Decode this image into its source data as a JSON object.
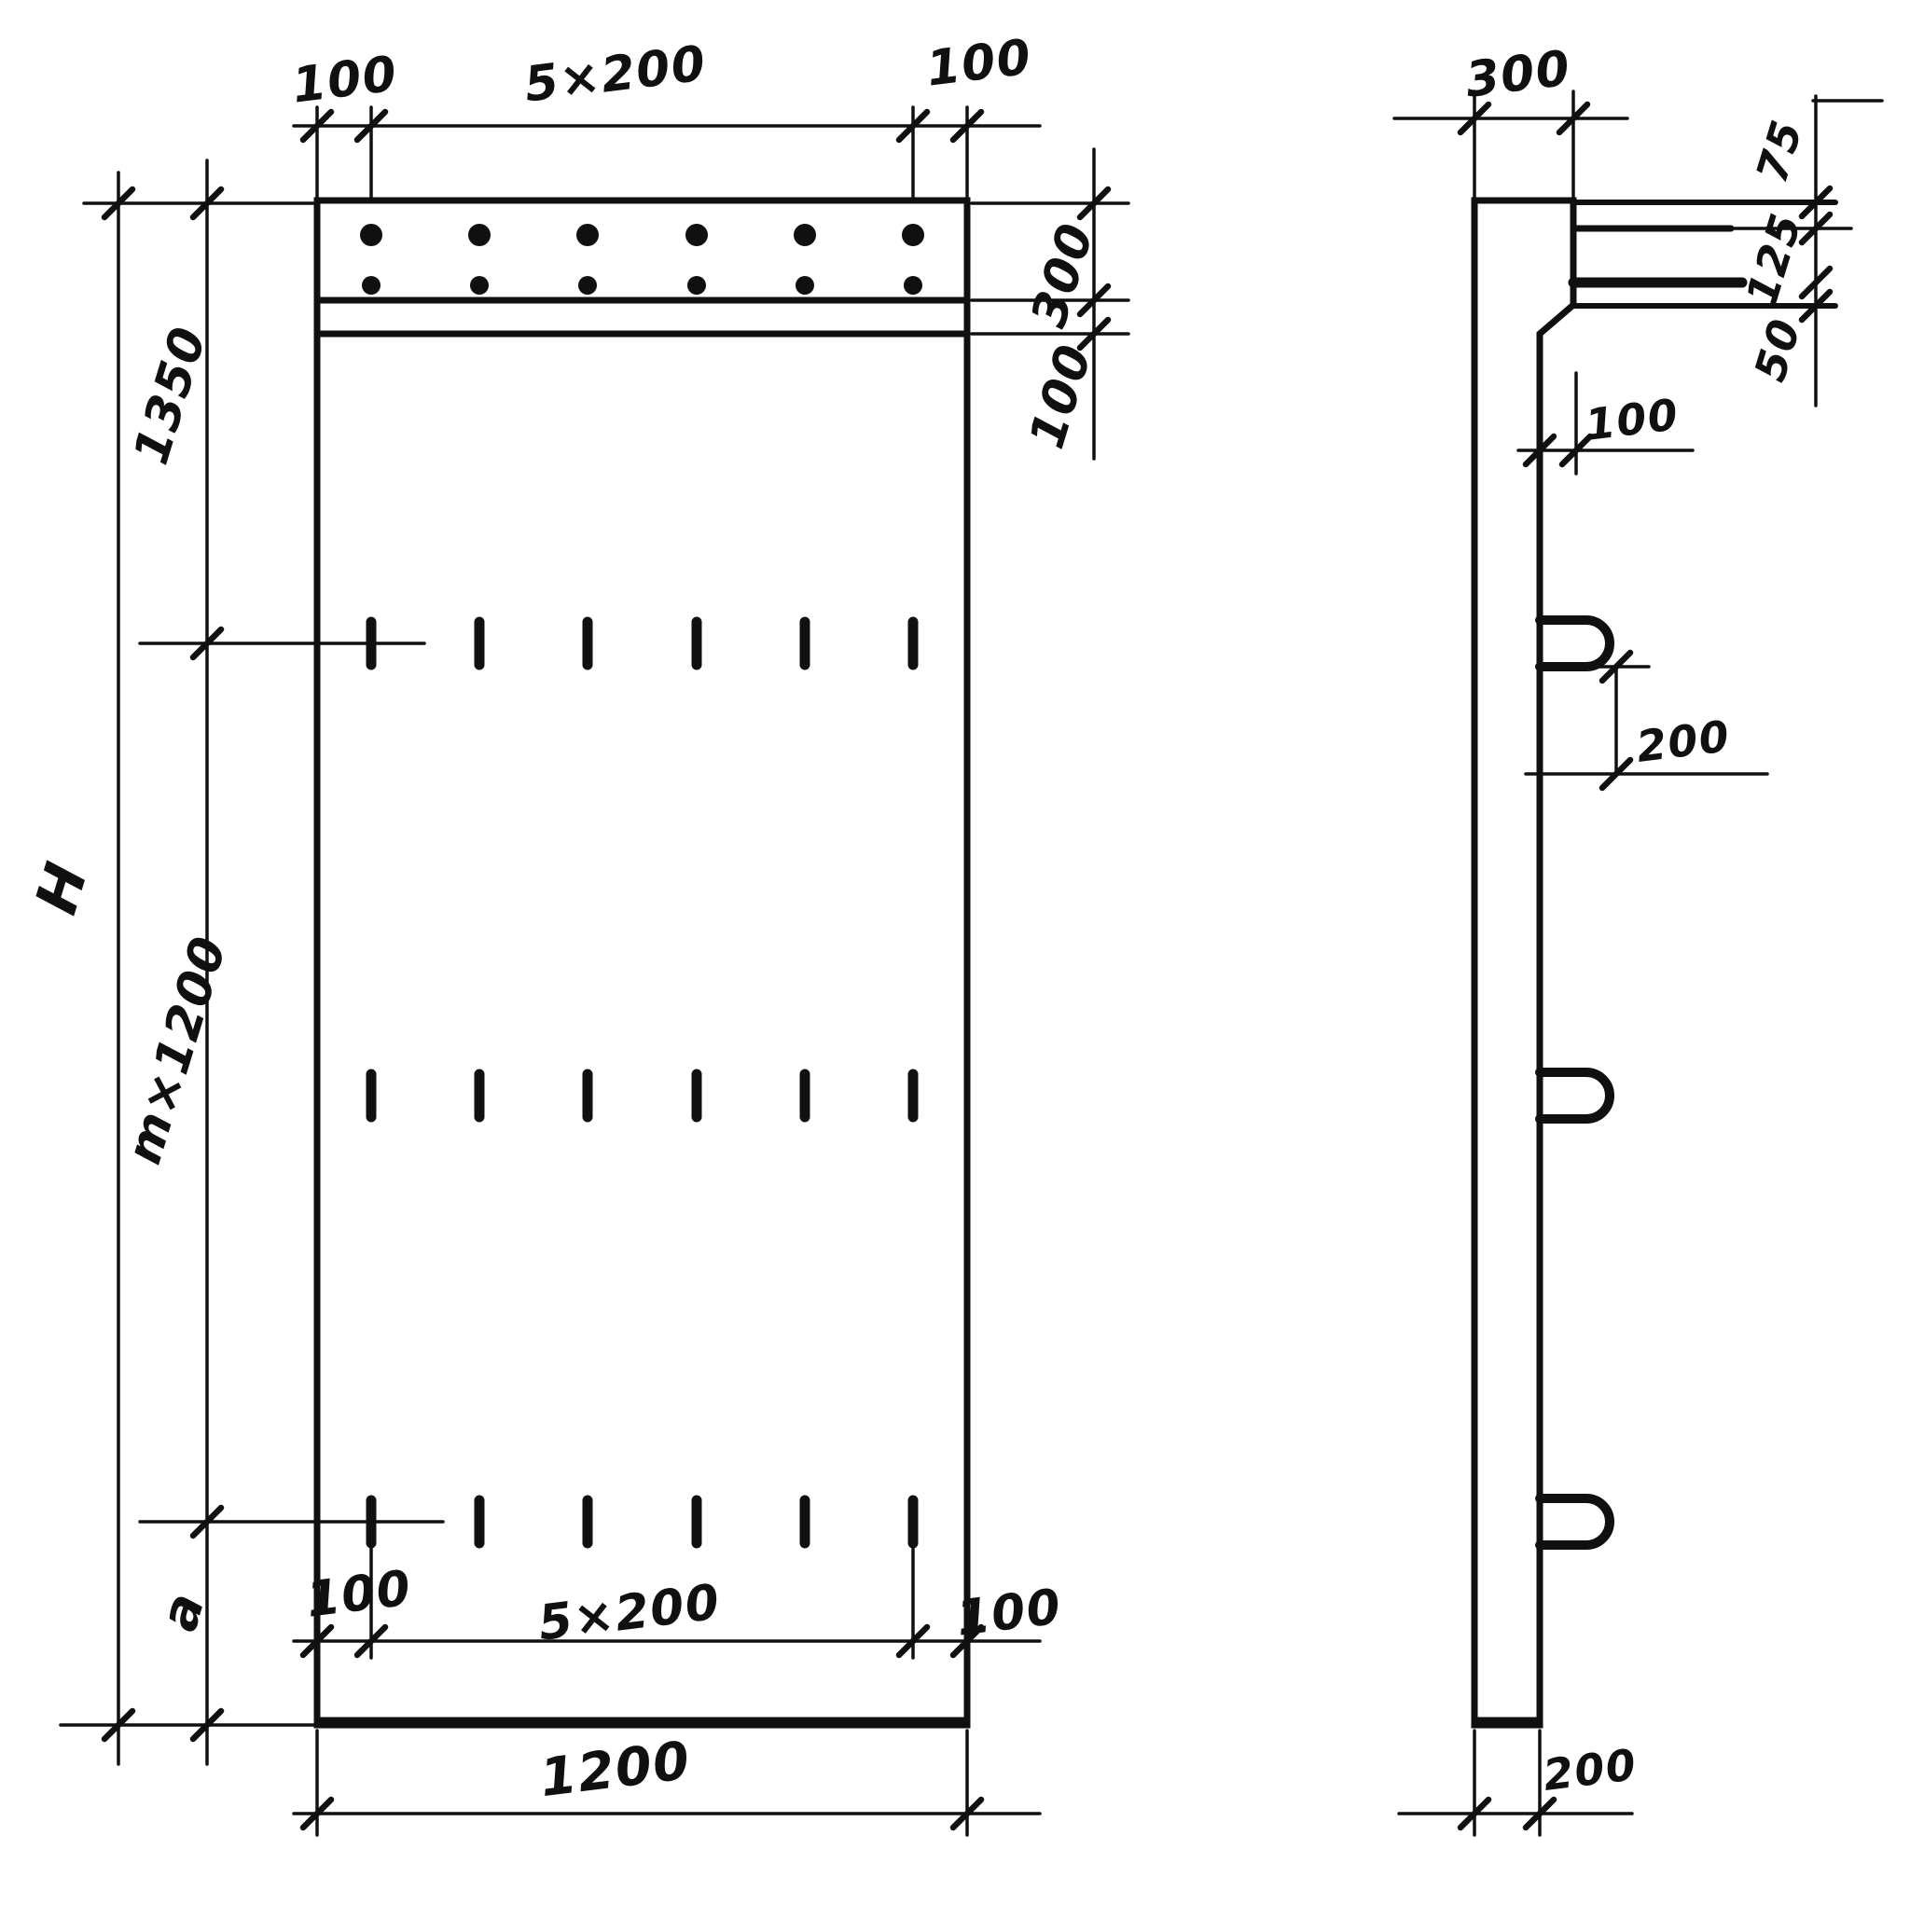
{
  "front_view": {
    "top_dims": {
      "left": "100",
      "center": "5×200",
      "right": "100"
    },
    "right_dims": {
      "band": "300",
      "ledge": "100"
    },
    "left_dims": {
      "total": "H",
      "top": "1350",
      "middle": "m×1200",
      "bottom": "a"
    },
    "bottom_dims": {
      "left": "100",
      "center": "5×200",
      "right": "100",
      "width": "1200"
    }
  },
  "side_view": {
    "top_dim": "300",
    "right_dims": {
      "top": "75",
      "middle": "125",
      "bottom": "50"
    },
    "step_dim": "100",
    "loop_dim": "200",
    "bottom_dim": "200"
  },
  "colors": {
    "ink": "#101010",
    "paper": "#ffffff"
  }
}
